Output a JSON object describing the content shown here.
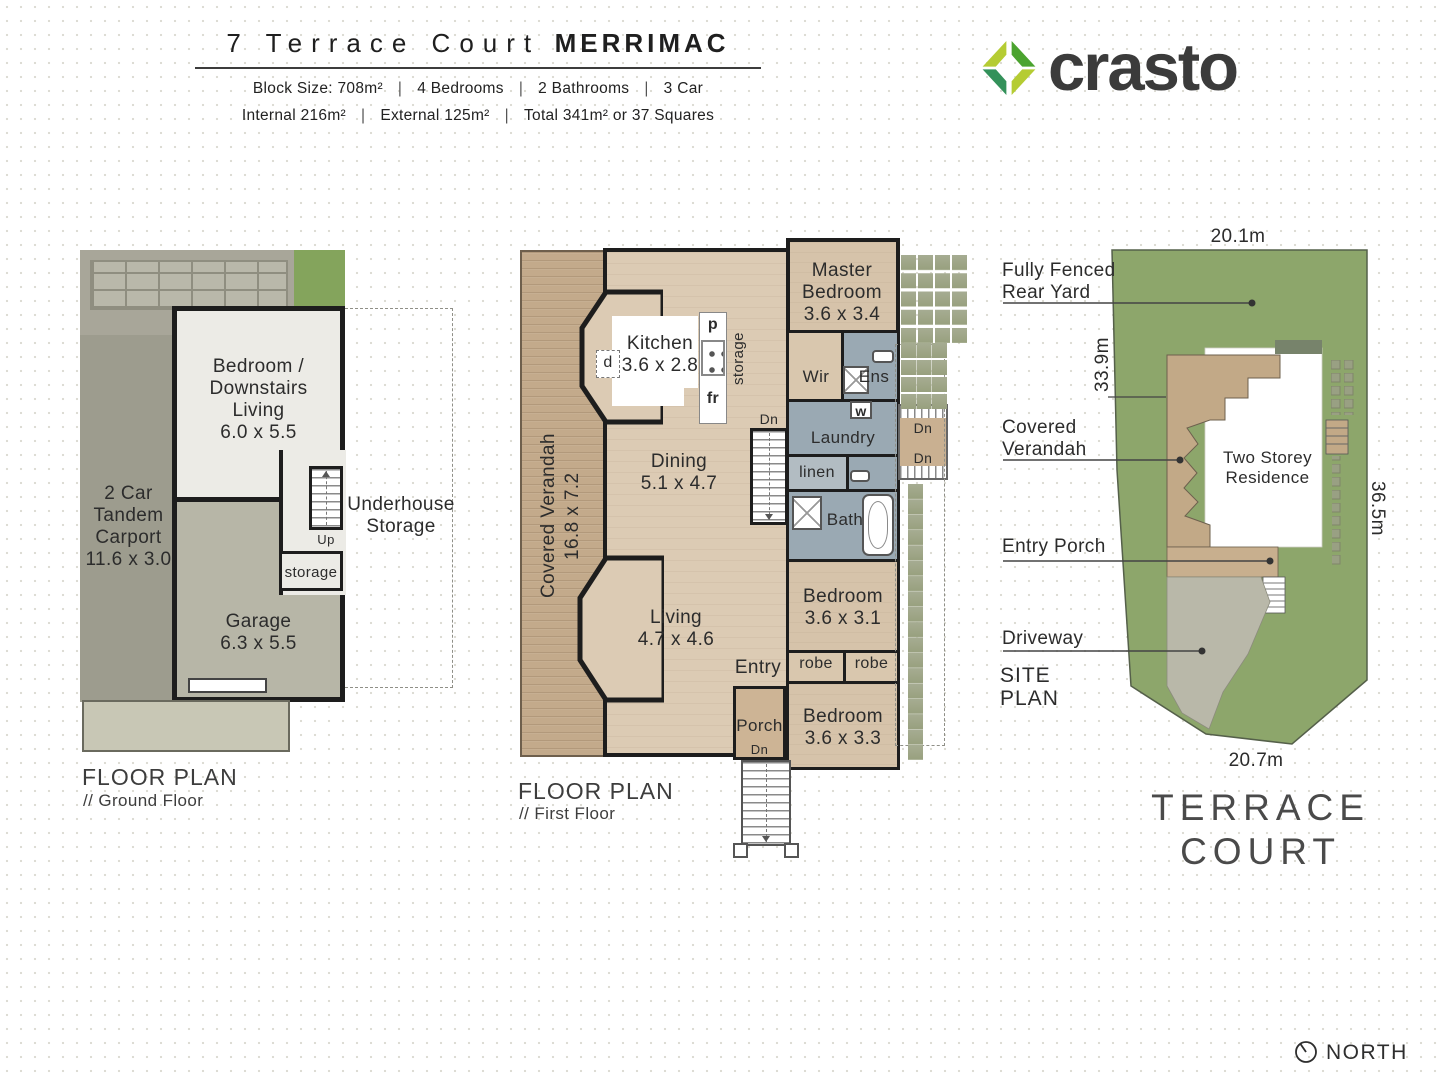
{
  "header": {
    "address": "7 Terrace Court",
    "suburb": "MERRIMAC",
    "sep": "|",
    "specs_line1": [
      "Block Size: 708m²",
      "4 Bedrooms",
      "2 Bathrooms",
      "3 Car"
    ],
    "specs_line2": [
      "Internal 216m²",
      "External 125m²",
      "Total 341m² or 37 Squares"
    ]
  },
  "logo": {
    "brand": "crasto"
  },
  "ground_floor": {
    "plan_title": "FLOOR PLAN",
    "plan_subtitle": "// Ground Floor",
    "carport_lines": [
      "2 Car",
      "Tandem",
      "Carport",
      "11.6 x 3.0"
    ],
    "bedroom_lines": [
      "Bedroom /",
      "Downstairs",
      "Living",
      "6.0 x 5.5"
    ],
    "garage_lines": [
      "Garage",
      "6.3 x 5.5"
    ],
    "underhouse_lines": [
      "Underhouse",
      "Storage"
    ],
    "storage_label": "storage",
    "up_label": "Up"
  },
  "first_floor": {
    "plan_title": "FLOOR PLAN",
    "plan_subtitle": "// First Floor",
    "verandah_name": "Covered Verandah",
    "verandah_dims": "16.8  x  7.2",
    "kitchen_lines": [
      "Kitchen",
      "3.6 x 2.8"
    ],
    "dining_lines": [
      "Dining",
      "5.1 x 4.7"
    ],
    "living_lines": [
      "Living",
      "4.7 x 4.6"
    ],
    "master_lines": [
      "Master",
      "Bedroom",
      "3.6 x 3.4"
    ],
    "bedroom2_lines": [
      "Bedroom",
      "3.6 x 3.1"
    ],
    "bedroom3_lines": [
      "Bedroom",
      "3.6 x 3.3"
    ],
    "wir_label": "Wir",
    "ens_label": "Ens",
    "laundry_label": "Laundry",
    "linen_label": "linen",
    "bath_label": "Bath",
    "robe_label": "robe",
    "entry_label": "Entry",
    "porch_label": "Porch",
    "storage_label": "storage",
    "pantry_label": "p",
    "fridge_label": "fr",
    "dishwasher_label": "d",
    "washer_label": "w",
    "dn_label": "Dn"
  },
  "site_plan": {
    "dim_top": "20.1m",
    "dim_left": "33.9m",
    "dim_right": "36.5m",
    "dim_bottom": "20.7m",
    "rear_yard_lines": [
      "Fully Fenced",
      "Rear Yard"
    ],
    "verandah_lines": [
      "Covered",
      "Verandah"
    ],
    "entry_porch_label": "Entry Porch",
    "driveway_label": "Driveway",
    "title_lines": [
      "SITE",
      "PLAN"
    ],
    "residence_lines": [
      "Two Storey",
      "Residence"
    ],
    "street_lines": [
      "TERRACE",
      "COURT"
    ]
  },
  "compass": {
    "north_label": "NORTH"
  },
  "colors": {
    "logo_text": "#3b3b3b",
    "logo_lime": "#b5cc33",
    "logo_green": "#4ba32f",
    "logo_emerald": "#33915a",
    "wall": "#1d1d1d",
    "deck_wood": "#c3aa8b",
    "interior_wood": "#dccbb4",
    "bedroom_wood": "#d6c3aa",
    "wet_area": "#9aa9b3",
    "grass": "#8da66b",
    "carport_concrete": "#a8a699",
    "driveway": "#b9b8a9"
  }
}
